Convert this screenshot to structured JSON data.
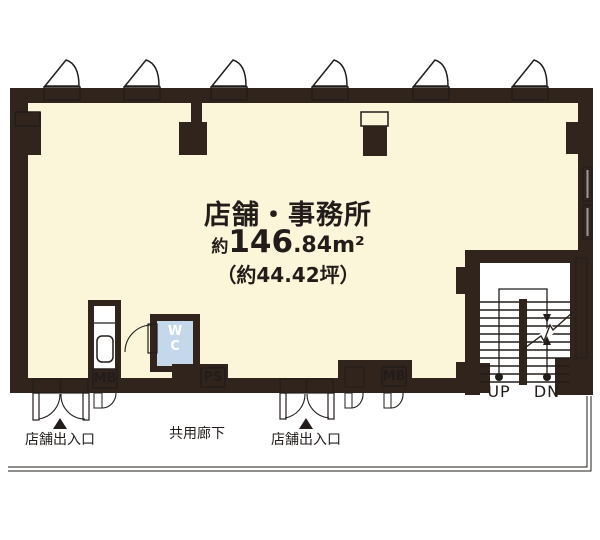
{
  "colors": {
    "wall": "#31241c",
    "floor": "#fbf5da",
    "wc_floor": "#c5d7ea",
    "outline": "#221d1a",
    "glass": "#9a9a9a",
    "white": "#ffffff"
  },
  "room": {
    "title": "店舗・事務所",
    "area_prefix": "約",
    "area_main": "146",
    "area_decimal": ".84",
    "area_unit": "m²",
    "area_tsubo": "（約44.42坪）"
  },
  "fixtures": {
    "wc_line1": "W",
    "wc_line2": "C",
    "mb_left": "MB",
    "ps": "PS",
    "mb_right": "MB"
  },
  "stairs": {
    "up": "UP",
    "dn": "DN"
  },
  "labels": {
    "entrance_left": "店舗出入口",
    "corridor": "共用廊下",
    "entrance_right": "店舗出入口"
  }
}
